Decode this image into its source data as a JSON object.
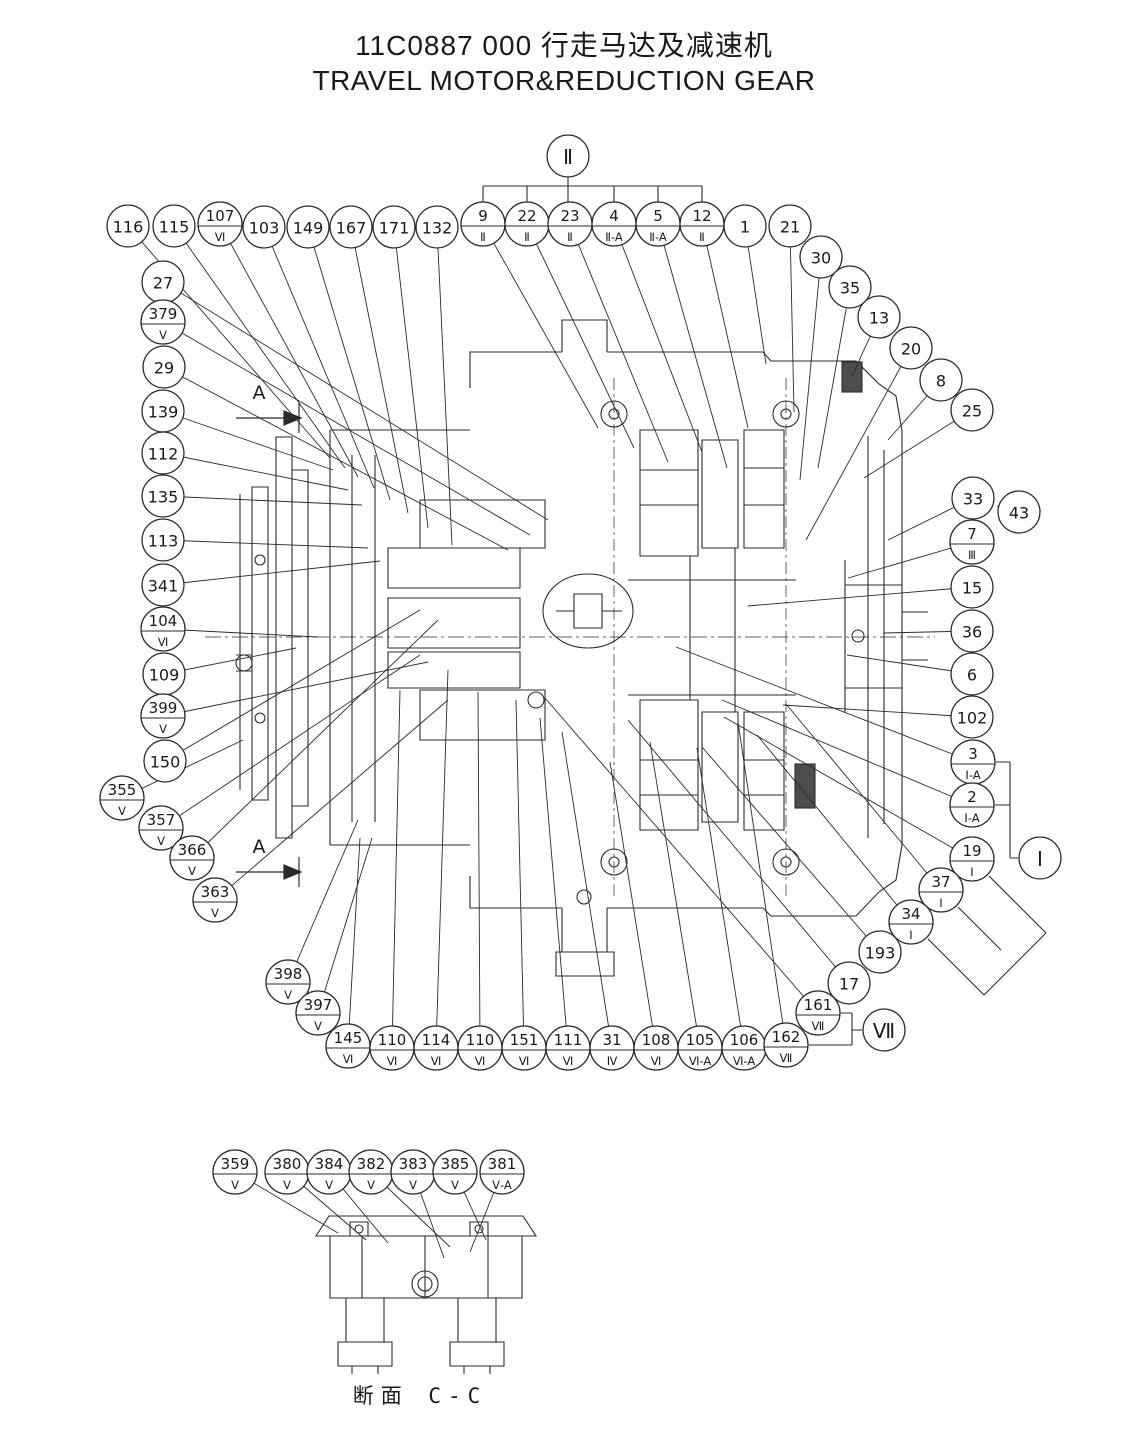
{
  "title": {
    "line1": "11C0887 000  行走马达及减速机",
    "line2": "TRAVEL MOTOR&REDUCTION GEAR"
  },
  "caption": {
    "text": "断面 C-C"
  },
  "section_arrows": [
    {
      "label": "A"
    },
    {
      "label": "A"
    }
  ],
  "section_balloons": [
    {
      "label": "Ⅱ",
      "x": 568,
      "y": 156
    },
    {
      "label": "Ⅰ",
      "x": 1040,
      "y": 858
    },
    {
      "label": "Ⅶ",
      "x": 884,
      "y": 1030
    }
  ],
  "balloons": [
    {
      "label": "116",
      "sub": "",
      "x": 128,
      "y": 226,
      "tx": 330,
      "ty": 458
    },
    {
      "label": "115",
      "sub": "",
      "x": 174,
      "y": 226,
      "tx": 345,
      "ty": 468
    },
    {
      "label": "107",
      "sub": "Ⅵ",
      "x": 220,
      "y": 224,
      "tx": 358,
      "ty": 477
    },
    {
      "label": "103",
      "sub": "",
      "x": 264,
      "y": 227,
      "tx": 374,
      "ty": 488
    },
    {
      "label": "149",
      "sub": "",
      "x": 308,
      "y": 227,
      "tx": 390,
      "ty": 500
    },
    {
      "label": "167",
      "sub": "",
      "x": 351,
      "y": 227,
      "tx": 408,
      "ty": 513
    },
    {
      "label": "171",
      "sub": "",
      "x": 394,
      "y": 227,
      "tx": 428,
      "ty": 528
    },
    {
      "label": "132",
      "sub": "",
      "x": 437,
      "y": 227,
      "tx": 452,
      "ty": 545
    },
    {
      "label": "9",
      "sub": "Ⅱ",
      "x": 483,
      "y": 224,
      "tx": 598,
      "ty": 428
    },
    {
      "label": "22",
      "sub": "Ⅱ",
      "x": 527,
      "y": 224,
      "tx": 634,
      "ty": 448
    },
    {
      "label": "23",
      "sub": "Ⅱ",
      "x": 570,
      "y": 224,
      "tx": 668,
      "ty": 462
    },
    {
      "label": "4",
      "sub": "Ⅱ-A",
      "x": 614,
      "y": 224,
      "tx": 702,
      "ty": 452
    },
    {
      "label": "5",
      "sub": "Ⅱ-A",
      "x": 658,
      "y": 224,
      "tx": 727,
      "ty": 468
    },
    {
      "label": "12",
      "sub": "Ⅱ",
      "x": 702,
      "y": 224,
      "tx": 748,
      "ty": 428
    },
    {
      "label": "1",
      "sub": "",
      "x": 745,
      "y": 226,
      "tx": 766,
      "ty": 364
    },
    {
      "label": "21",
      "sub": "",
      "x": 790,
      "y": 226,
      "tx": 794,
      "ty": 412
    },
    {
      "label": "30",
      "sub": "",
      "x": 821,
      "y": 257,
      "tx": 800,
      "ty": 480
    },
    {
      "label": "35",
      "sub": "",
      "x": 850,
      "y": 287,
      "tx": 818,
      "ty": 468
    },
    {
      "label": "13",
      "sub": "",
      "x": 879,
      "y": 317,
      "tx": 852,
      "ty": 376
    },
    {
      "label": "20",
      "sub": "",
      "x": 911,
      "y": 348,
      "tx": 806,
      "ty": 540
    },
    {
      "label": "8",
      "sub": "",
      "x": 941,
      "y": 380,
      "tx": 888,
      "ty": 440
    },
    {
      "label": "25",
      "sub": "",
      "x": 972,
      "y": 410,
      "tx": 864,
      "ty": 478
    },
    {
      "label": "33",
      "sub": "",
      "x": 973,
      "y": 498,
      "tx": 888,
      "ty": 540
    },
    {
      "label": "43",
      "sub": "",
      "x": 1019,
      "y": 512,
      "tx": 997,
      "ty": 506
    },
    {
      "label": "7",
      "sub": "Ⅲ",
      "x": 972,
      "y": 542,
      "tx": 848,
      "ty": 578
    },
    {
      "label": "15",
      "sub": "",
      "x": 972,
      "y": 587,
      "tx": 748,
      "ty": 606
    },
    {
      "label": "36",
      "sub": "",
      "x": 972,
      "y": 631,
      "tx": 884,
      "ty": 633
    },
    {
      "label": "6",
      "sub": "",
      "x": 972,
      "y": 674,
      "tx": 847,
      "ty": 655
    },
    {
      "label": "102",
      "sub": "",
      "x": 972,
      "y": 717,
      "tx": 783,
      "ty": 705
    },
    {
      "label": "3",
      "sub": "Ⅰ-A",
      "x": 973,
      "y": 762,
      "tx": 676,
      "ty": 647
    },
    {
      "label": "2",
      "sub": "Ⅰ-A",
      "x": 972,
      "y": 805,
      "tx": 722,
      "ty": 700
    },
    {
      "label": "19",
      "sub": "Ⅰ",
      "x": 972,
      "y": 859,
      "tx": 724,
      "ty": 717
    },
    {
      "label": "37",
      "sub": "Ⅰ",
      "x": 941,
      "y": 890,
      "tx": 786,
      "ty": 704
    },
    {
      "label": "34",
      "sub": "Ⅰ",
      "x": 911,
      "y": 922,
      "tx": 757,
      "ty": 735
    },
    {
      "label": "193",
      "sub": "",
      "x": 880,
      "y": 952,
      "tx": 702,
      "ty": 747
    },
    {
      "label": "17",
      "sub": "",
      "x": 849,
      "y": 983,
      "tx": 628,
      "ty": 720
    },
    {
      "label": "161",
      "sub": "Ⅶ",
      "x": 818,
      "y": 1013,
      "tx": 545,
      "ty": 698
    },
    {
      "label": "27",
      "sub": "",
      "x": 163,
      "y": 282,
      "tx": 548,
      "ty": 520
    },
    {
      "label": "379",
      "sub": "Ⅴ",
      "x": 163,
      "y": 322,
      "tx": 530,
      "ty": 535
    },
    {
      "label": "29",
      "sub": "",
      "x": 164,
      "y": 367,
      "tx": 508,
      "ty": 550
    },
    {
      "label": "139",
      "sub": "",
      "x": 163,
      "y": 411,
      "tx": 333,
      "ty": 470
    },
    {
      "label": "112",
      "sub": "",
      "x": 163,
      "y": 453,
      "tx": 348,
      "ty": 490
    },
    {
      "label": "135",
      "sub": "",
      "x": 163,
      "y": 496,
      "tx": 362,
      "ty": 505
    },
    {
      "label": "113",
      "sub": "",
      "x": 163,
      "y": 540,
      "tx": 368,
      "ty": 548
    },
    {
      "label": "341",
      "sub": "",
      "x": 163,
      "y": 585,
      "tx": 380,
      "ty": 561
    },
    {
      "label": "104",
      "sub": "Ⅵ",
      "x": 163,
      "y": 629,
      "tx": 318,
      "ty": 637
    },
    {
      "label": "109",
      "sub": "",
      "x": 164,
      "y": 674,
      "tx": 296,
      "ty": 648
    },
    {
      "label": "399",
      "sub": "Ⅴ",
      "x": 163,
      "y": 716,
      "tx": 428,
      "ty": 662
    },
    {
      "label": "150",
      "sub": "",
      "x": 165,
      "y": 761,
      "tx": 420,
      "ty": 610
    },
    {
      "label": "355",
      "sub": "Ⅴ",
      "x": 122,
      "y": 798,
      "tx": 243,
      "ty": 740
    },
    {
      "label": "357",
      "sub": "Ⅴ",
      "x": 161,
      "y": 828,
      "tx": 420,
      "ty": 655
    },
    {
      "label": "366",
      "sub": "Ⅴ",
      "x": 192,
      "y": 858,
      "tx": 438,
      "ty": 620
    },
    {
      "label": "363",
      "sub": "Ⅴ",
      "x": 215,
      "y": 900,
      "tx": 448,
      "ty": 700
    },
    {
      "label": "398",
      "sub": "Ⅴ",
      "x": 288,
      "y": 982,
      "tx": 358,
      "ty": 820
    },
    {
      "label": "397",
      "sub": "Ⅴ",
      "x": 318,
      "y": 1013,
      "tx": 372,
      "ty": 838
    },
    {
      "label": "145",
      "sub": "Ⅵ",
      "x": 348,
      "y": 1046,
      "tx": 360,
      "ty": 838
    },
    {
      "label": "110",
      "sub": "Ⅵ",
      "x": 392,
      "y": 1048,
      "tx": 400,
      "ty": 690
    },
    {
      "label": "114",
      "sub": "Ⅵ",
      "x": 436,
      "y": 1048,
      "tx": 448,
      "ty": 670
    },
    {
      "label": "110",
      "sub": "Ⅵ",
      "x": 480,
      "y": 1048,
      "tx": 478,
      "ty": 692
    },
    {
      "label": "151",
      "sub": "Ⅵ",
      "x": 524,
      "y": 1048,
      "tx": 516,
      "ty": 700
    },
    {
      "label": "111",
      "sub": "Ⅵ",
      "x": 568,
      "y": 1048,
      "tx": 540,
      "ty": 718
    },
    {
      "label": "31",
      "sub": "Ⅳ",
      "x": 612,
      "y": 1048,
      "tx": 562,
      "ty": 732
    },
    {
      "label": "108",
      "sub": "Ⅵ",
      "x": 656,
      "y": 1048,
      "tx": 610,
      "ty": 762
    },
    {
      "label": "105",
      "sub": "Ⅵ-A",
      "x": 700,
      "y": 1048,
      "tx": 650,
      "ty": 742
    },
    {
      "label": "106",
      "sub": "Ⅵ-A",
      "x": 744,
      "y": 1048,
      "tx": 697,
      "ty": 748
    },
    {
      "label": "162",
      "sub": "Ⅶ",
      "x": 786,
      "y": 1045,
      "tx": 738,
      "ty": 722
    },
    {
      "label": "359",
      "sub": "Ⅴ",
      "x": 235,
      "y": 1172,
      "tx": 338,
      "ty": 1233
    },
    {
      "label": "380",
      "sub": "Ⅴ",
      "x": 287,
      "y": 1172,
      "tx": 366,
      "ty": 1240
    },
    {
      "label": "384",
      "sub": "Ⅴ",
      "x": 329,
      "y": 1172,
      "tx": 388,
      "ty": 1243
    },
    {
      "label": "382",
      "sub": "Ⅴ",
      "x": 371,
      "y": 1172,
      "tx": 450,
      "ty": 1247
    },
    {
      "label": "383",
      "sub": "Ⅴ",
      "x": 413,
      "y": 1172,
      "tx": 444,
      "ty": 1258
    },
    {
      "label": "385",
      "sub": "Ⅴ",
      "x": 455,
      "y": 1172,
      "tx": 486,
      "ty": 1240
    },
    {
      "label": "381",
      "sub": "Ⅴ-A",
      "x": 502,
      "y": 1172,
      "tx": 470,
      "ty": 1252
    }
  ]
}
